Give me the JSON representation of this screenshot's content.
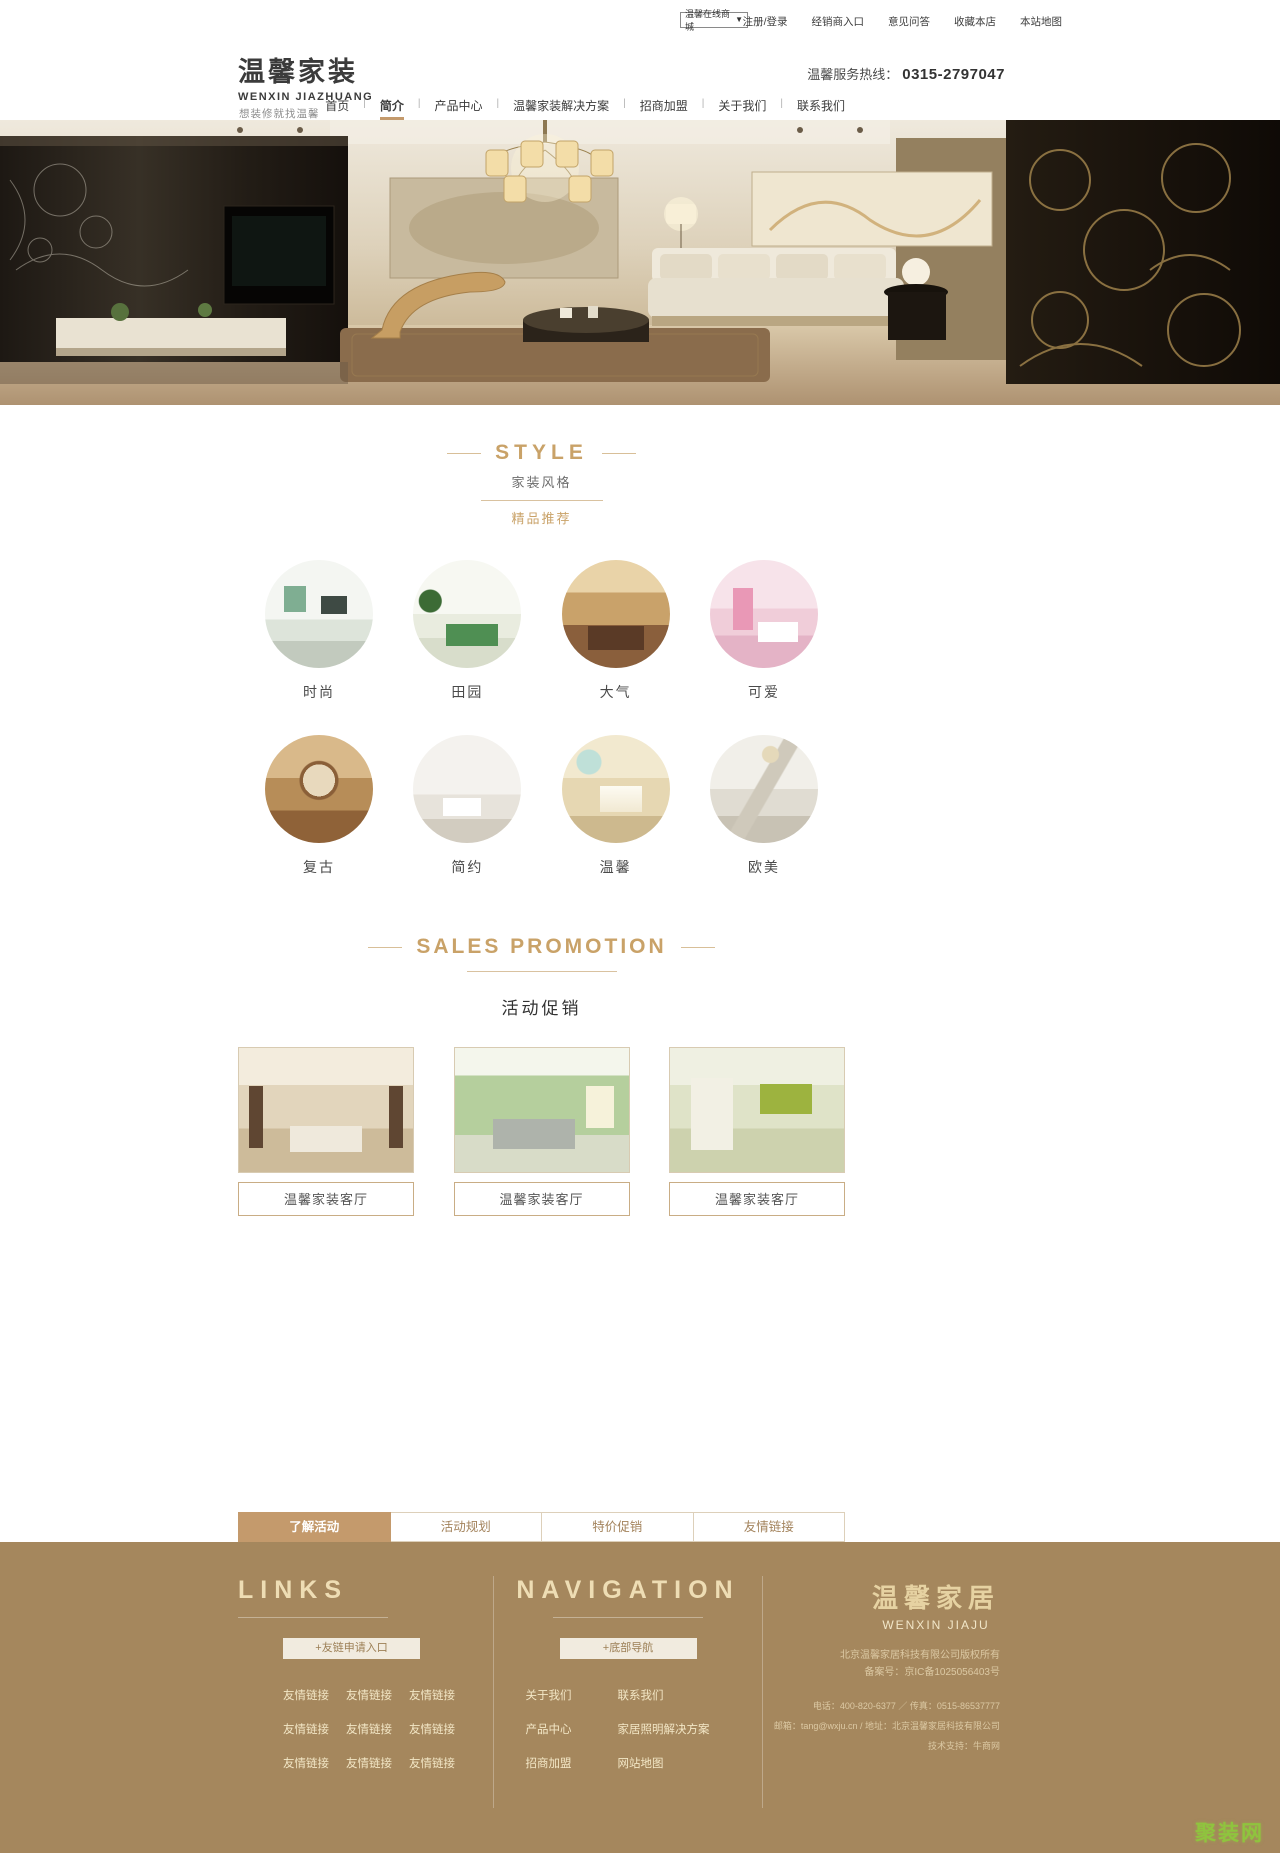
{
  "topbar": {
    "mall_dropdown": "温馨在线商城",
    "links": [
      "注册/登录",
      "经销商入口",
      "意见问答",
      "收藏本店",
      "本站地图"
    ]
  },
  "icons": {
    "dropdown_arrow": "▼"
  },
  "header": {
    "logo_title": "温馨家装",
    "logo_subtitle": "WENXIN JIAZHUANG",
    "tagline": "想装修就找温馨",
    "hotline_label": "温馨服务热线：",
    "hotline_number": "0315-2797047"
  },
  "nav": {
    "items": [
      "首页",
      "简介",
      "产品中心",
      "温馨家装解决方案",
      "招商加盟",
      "关于我们",
      "联系我们"
    ],
    "active_item": "简介"
  },
  "style_section": {
    "title": "STYLE",
    "subtitle": "家装风格",
    "badge": "精品推荐",
    "items": [
      "时尚",
      "田园",
      "大气",
      "可爱",
      "复古",
      "简约",
      "温馨",
      "欧美"
    ]
  },
  "promo_section": {
    "title": "SALES PROMOTION",
    "subtitle": "活动促销",
    "cards": [
      "温馨家装客厅",
      "温馨家装客厅",
      "温馨家装客厅"
    ]
  },
  "tabs": {
    "items": [
      "了解活动",
      "活动规划",
      "特价促销",
      "友情链接"
    ],
    "active_item": "了解活动"
  },
  "footer": {
    "links_column": {
      "title": "LINKS",
      "button": "+友链申请入口",
      "links": [
        "友情链接",
        "友情链接",
        "友情链接",
        "友情链接",
        "友情链接",
        "友情链接",
        "友情链接",
        "友情链接",
        "友情链接"
      ]
    },
    "nav_column": {
      "title": "NAVIGATION",
      "button": "+底部导航",
      "links": [
        "关于我们",
        "联系我们",
        "产品中心",
        "家居照明解决方案",
        "招商加盟",
        "网站地图"
      ]
    },
    "company_column": {
      "logo_title": "温馨家居",
      "logo_subtitle": "WENXIN JIAJU",
      "copyright_line1": "北京温馨家居科技有限公司版权所有",
      "copyright_line2": "备案号：京IC备1025056403号",
      "contact_line1": "电话：400-820-6377 ／ 传真：0515-86537777",
      "contact_line2": "邮箱：tang@wxju.cn / 地址：北京温馨家居科技有限公司",
      "contact_line3": "技术支持：牛商网"
    }
  },
  "watermark": "聚装网",
  "colors": {
    "accent": "#c49a6c",
    "title_gold": "#c9a268",
    "footer_bg": "#a5875d"
  }
}
